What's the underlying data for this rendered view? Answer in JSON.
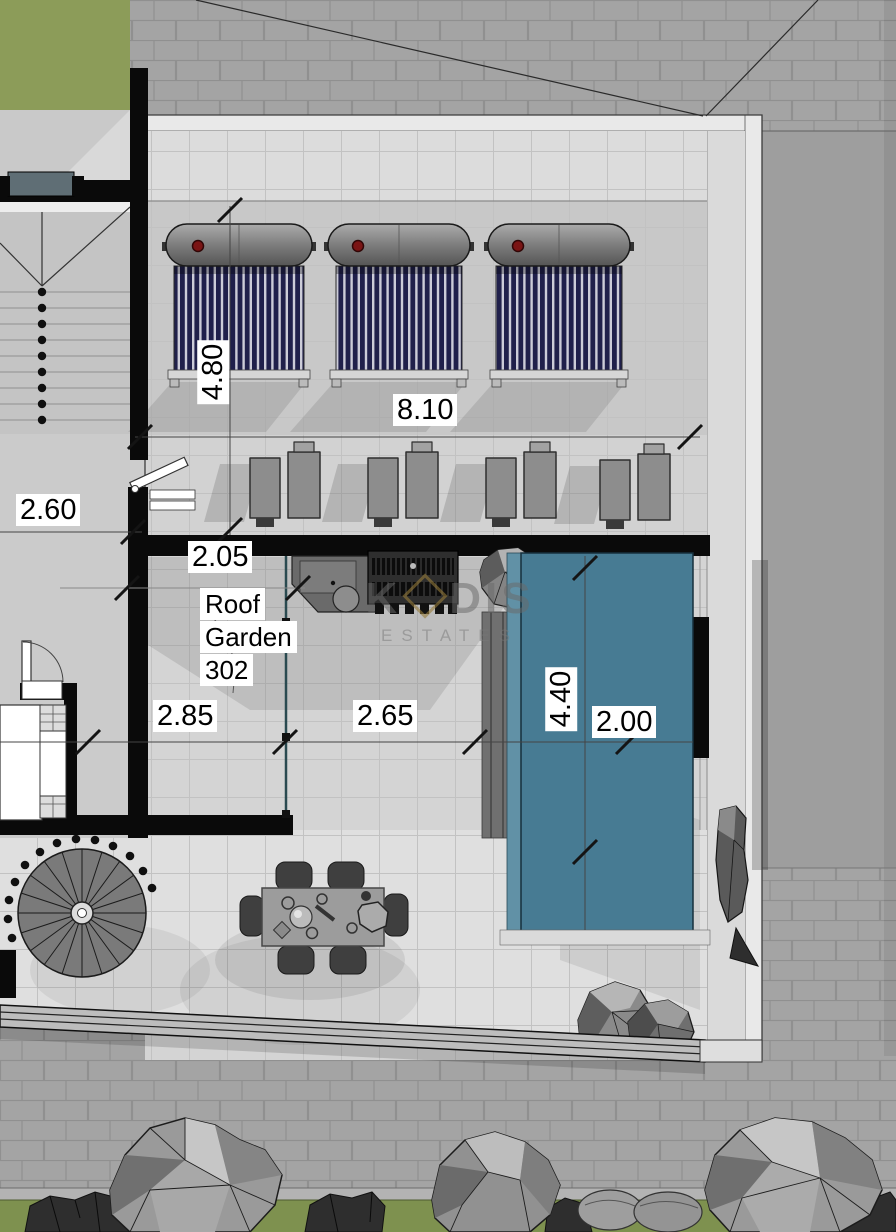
{
  "plan": {
    "room_label": {
      "line1": "Roof",
      "line2": "Garden",
      "line3": "302"
    },
    "dimensions": {
      "d480": "4.80",
      "d810": "8.10",
      "d260": "2.60",
      "d205": "2.05",
      "d285": "2.85",
      "d265": "2.65",
      "d440": "4.40",
      "d200": "2.00"
    },
    "watermark": {
      "prefix": "K",
      "suffix": "DIS",
      "tagline": "ESTATES"
    },
    "colors": {
      "pool": "#477b93",
      "pool_edge": "#6191a6",
      "lawn_top": "#8c9c59",
      "hedge_strip": "#7e914f",
      "wall": "#0a0a0a",
      "brick": "#a4a4a4",
      "terrace": "#d4d4d4",
      "solar_tube": "#20204b",
      "watermark_gold": "#9c7c3a"
    }
  }
}
